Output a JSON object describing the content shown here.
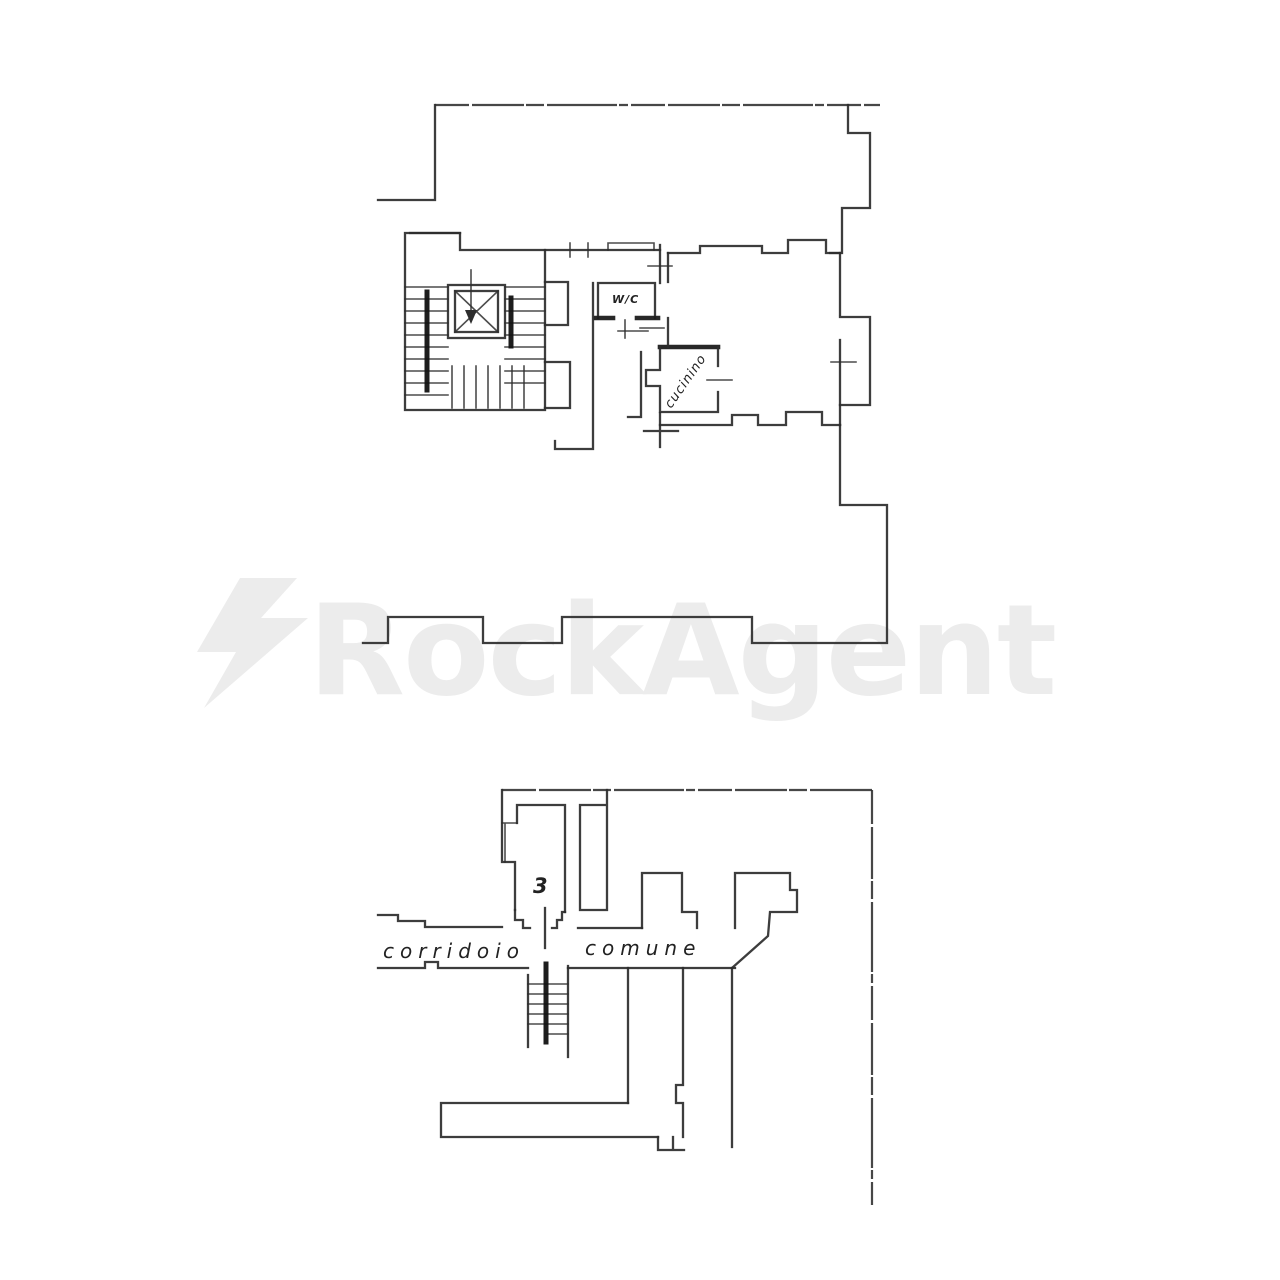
{
  "watermark": {
    "brand": "RockAgent",
    "color": "#ececec",
    "icon": "lightning-bolt-icon"
  },
  "upper_plan": {
    "labels": {
      "wc": "W/C",
      "kitchenette": "cucinino"
    }
  },
  "lower_plan": {
    "labels": {
      "room_number": "3",
      "corridor_word_left": "corridoio",
      "corridor_word_right": "comune"
    }
  },
  "style": {
    "line_color": "#2d2d2d",
    "paper_color": "#ffffff"
  }
}
